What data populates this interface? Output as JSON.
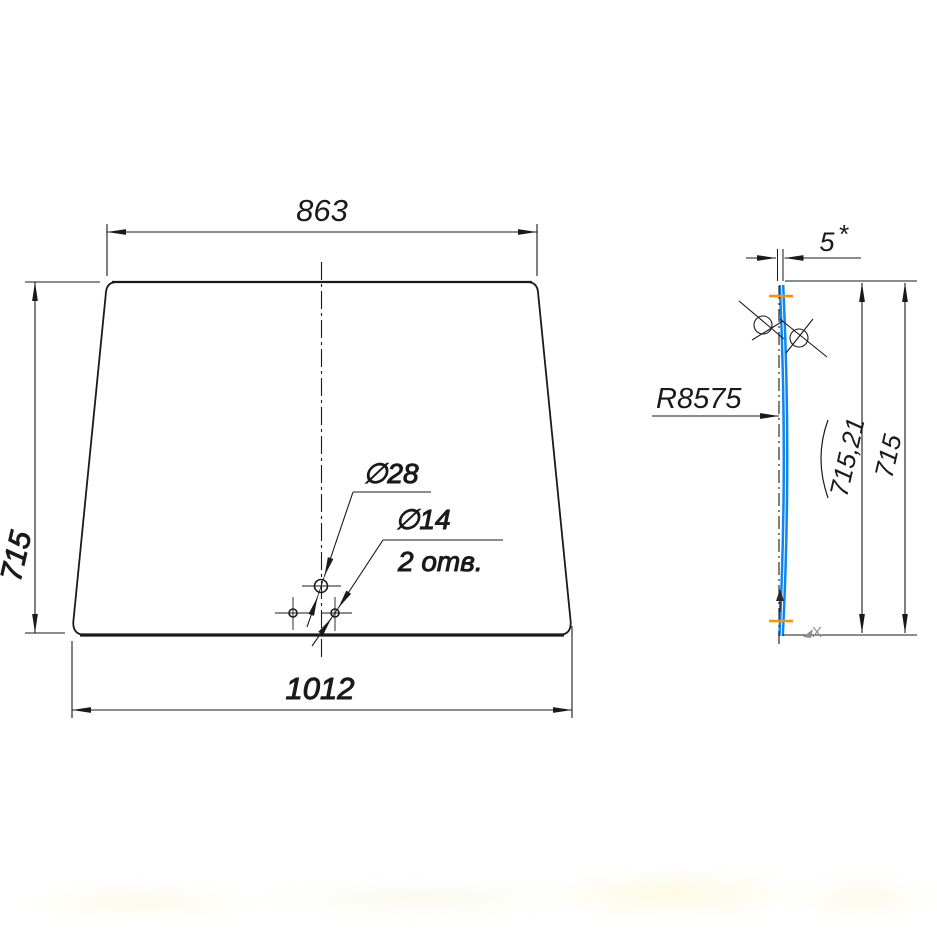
{
  "front_view": {
    "top_width": "863",
    "bottom_width": "1012",
    "height": "715",
    "large_hole_diameter": "∅28",
    "small_hole_diameter": "∅14",
    "small_hole_count": "2 отв."
  },
  "side_view": {
    "thickness": "5",
    "thickness_tolerance_mark": "*",
    "bend_radius": "R8575",
    "arc_length": "715,21",
    "chord_height": "715",
    "axis_marker": "X"
  },
  "colors": {
    "line_black": "#1a1a1a",
    "glass_profile_blue": "#0d86f3",
    "snap_marker_orange": "#ff9100",
    "axis_marker_gray": "#8f8f8f"
  }
}
